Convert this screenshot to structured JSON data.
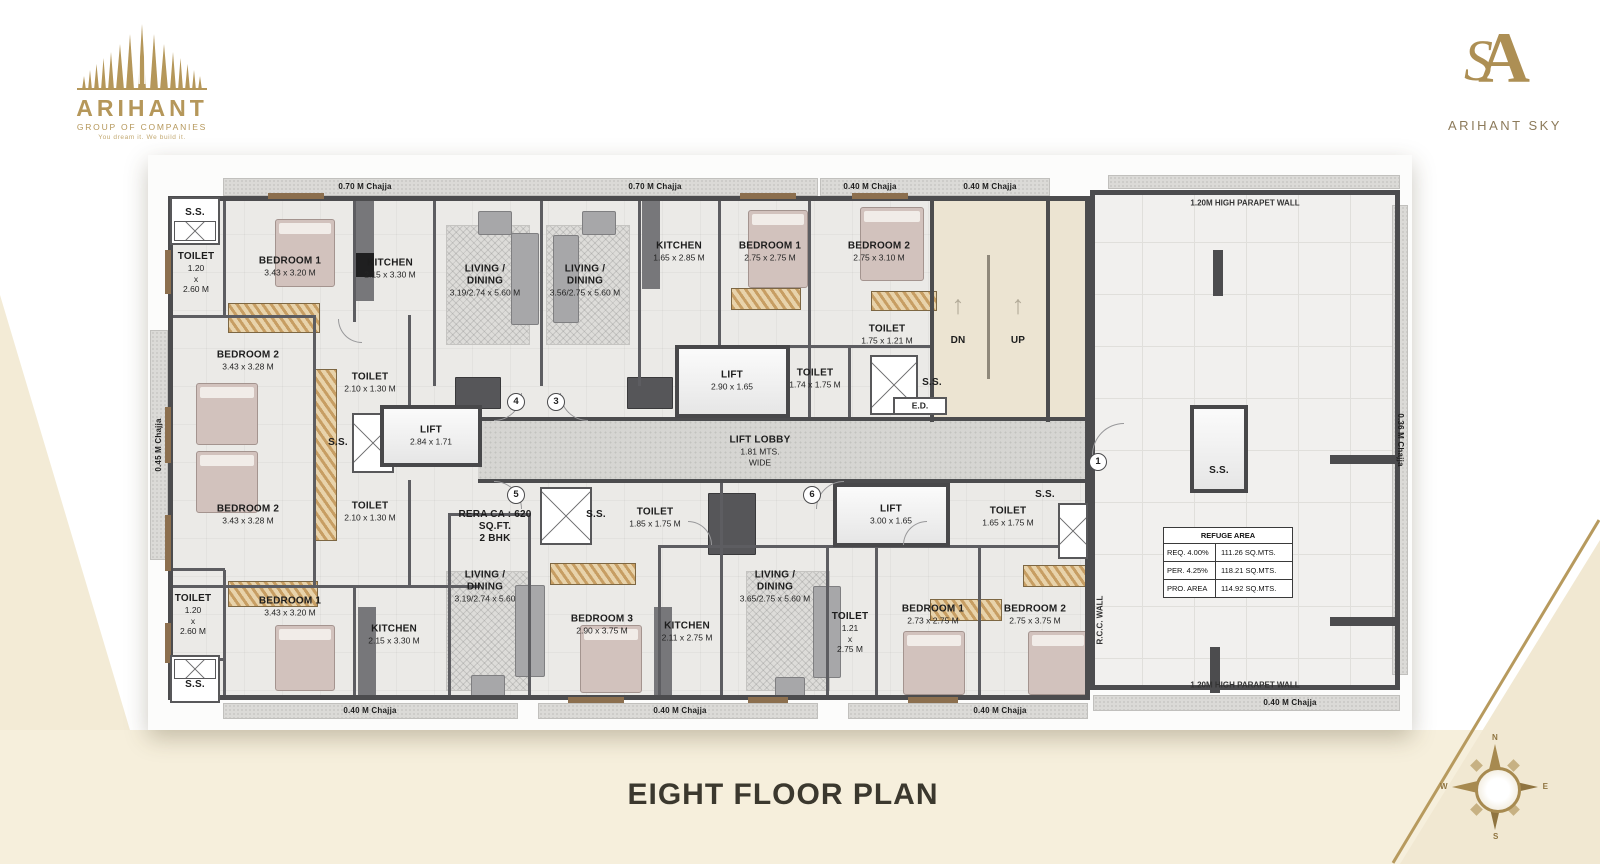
{
  "branding": {
    "group": {
      "name": "ARIHANT",
      "subtitle": "GROUP OF COMPANIES",
      "tagline": "You dream it. We build it."
    },
    "project": {
      "monogram_a": "A",
      "monogram_s": "S",
      "name": "ARIHANT SKY"
    }
  },
  "title": "EIGHT FLOOR PLAN",
  "compass": {
    "n": "N",
    "e": "E",
    "s": "S",
    "w": "W"
  },
  "colors": {
    "gold": "#b5975a",
    "cream": "#f3ebd6",
    "wall": "#4c4c4e",
    "title_text": "#3b382e"
  },
  "plan": {
    "chajja_top": [
      "0.70 M Chajja",
      "0.70 M Chajja",
      "0.40 M Chajja",
      "0.40 M Chajja"
    ],
    "chajja_bottom": [
      "0.40 M Chajja",
      "0.40 M Chajja",
      "0.40 M Chajja",
      "0.40 M Chajja"
    ],
    "chajja_left": "0.45 M Chajja",
    "chajja_right": "0.36 M Chajja",
    "parapet_top": "1.20M HIGH PARAPET WALL",
    "parapet_bottom": "1.20M HIGH PARAPET WALL",
    "rcc_wall": "R.C.C. WALL",
    "stairs": {
      "dn": "DN",
      "up": "UP",
      "arrow": "↑"
    },
    "units": {
      "u1": "1",
      "u3": "3",
      "u4": "4",
      "u5": "5",
      "u6": "6"
    },
    "lobby": {
      "name": "LIFT LOBBY",
      "size": "1.81 MTS.",
      "wide": "WIDE"
    },
    "rera": {
      "l1": "RERA CA : 620",
      "l2": "SQ.FT.",
      "l3": "2 BHK"
    },
    "ed": "E.D.",
    "lifts": {
      "left": {
        "name": "LIFT",
        "dims": "2.84  x 1.71"
      },
      "center": {
        "name": "LIFT",
        "dims": "2.90  x 1.65"
      },
      "right": {
        "name": "LIFT",
        "dims": "3.00  x 1.65"
      },
      "refuge": {
        "name": "S.S."
      }
    },
    "rooms": {
      "ss_tl": "S.S.",
      "ss_bl": "S.S.",
      "ss_ml": "S.S.",
      "ss_c1": "S.S.",
      "ss_cb": "S.S.",
      "ss_cr": "S.S.",
      "toilet_tl": {
        "name": "TOILET",
        "l1": "1.20",
        "l2": "x",
        "l3": "2.60 M"
      },
      "bed1_tl": {
        "name": "BEDROOM 1",
        "dims": "3.43 x 3.20 M"
      },
      "kitchen_tl": {
        "name": "KITCHEN",
        "dims": "2.15 x 3.30 M"
      },
      "living_t1": {
        "n1": "LIVING /",
        "n2": "DINING",
        "dims": "3.19/2.74 x 5.60 M"
      },
      "living_t2": {
        "n1": "LIVING /",
        "n2": "DINING",
        "dims": "3.56/2.75 x 5.60 M"
      },
      "kitchen_tc": {
        "name": "KITCHEN",
        "dims": "1.65 x 2.85 M"
      },
      "bed1_tr": {
        "name": "BEDROOM 1",
        "dims": "2.75 x 2.75 M"
      },
      "bed2_tr": {
        "name": "BEDROOM 2",
        "dims": "2.75 x 3.10 M"
      },
      "toilet_tr": {
        "name": "TOILET",
        "dims": "1.75 x 1.21 M"
      },
      "toilet_c1": {
        "name": "TOILET",
        "dims": "1.74 x 1.75 M"
      },
      "bed2_ml_up": {
        "name": "BEDROOM 2",
        "dims": "3.43 x 3.28 M"
      },
      "toilet_ml_up": {
        "name": "TOILET",
        "dims": "2.10 x 1.30 M"
      },
      "bed2_ml_low": {
        "name": "BEDROOM 2",
        "dims": "3.43 x 3.28 M"
      },
      "toilet_ml_low": {
        "name": "TOILET",
        "dims": "2.10 x 1.30 M"
      },
      "toilet_cb": {
        "name": "TOILET",
        "dims": "1.85 x 1.75 M"
      },
      "toilet_cr": {
        "name": "TOILET",
        "dims": "1.65 x 1.75 M"
      },
      "toilet_bl": {
        "name": "TOILET",
        "l1": "1.20",
        "l2": "x",
        "l3": "2.60 M"
      },
      "bed1_bl": {
        "name": "BEDROOM 1",
        "dims": "3.43 x 3.20 M"
      },
      "kitchen_bl": {
        "name": "KITCHEN",
        "dims": "2.15 x 3.30 M"
      },
      "living_b1": {
        "n1": "LIVING /",
        "n2": "DINING",
        "dims": "3.19/2.74 x 5.60"
      },
      "bed3_b": {
        "name": "BEDROOM 3",
        "dims": "2.90 x 3.75 M"
      },
      "kitchen_bc": {
        "name": "KITCHEN",
        "dims": "2.11 x 2.75 M"
      },
      "living_b2": {
        "n1": "LIVING /",
        "n2": "DINING",
        "dims": "3.65/2.75 x 5.60 M"
      },
      "toilet_bc": {
        "name": "TOILET",
        "l1": "1.21",
        "l2": "x",
        "l3": "2.75 M"
      },
      "bed1_br": {
        "name": "BEDROOM 1",
        "dims": "2.73 x 2.75 M"
      },
      "bed2_br": {
        "name": "BEDROOM 2",
        "dims": "2.75 x 3.75 M"
      }
    },
    "refuge_table": {
      "header": "REFUGE AREA",
      "rows": [
        {
          "label": "REQ. 4.00%",
          "value": "111.26  SQ.MTS."
        },
        {
          "label": "PER.  4.25%",
          "value": "118.21  SQ.MTS."
        },
        {
          "label": "PRO. AREA",
          "value": "114.92  SQ.MTS."
        }
      ]
    }
  }
}
